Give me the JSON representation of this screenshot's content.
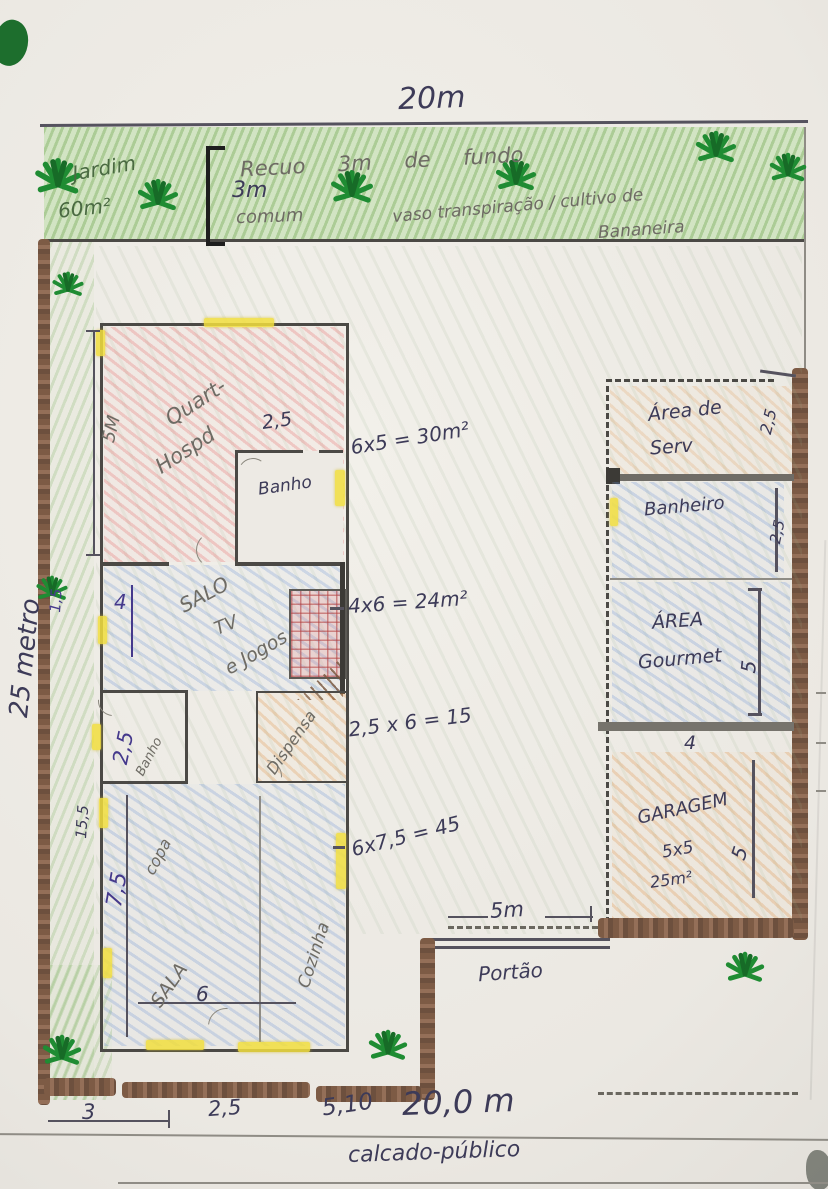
{
  "page": {
    "width_label": "20m",
    "depth_label": "25 metro"
  },
  "garden": {
    "name": "Jardim",
    "area": "60m²",
    "bracket": "3m",
    "recuo_line": "Recuo  3m  de  fundo",
    "comum": "comum",
    "note_main": "vaso transpiração / cultivo de",
    "note_tail": "Bananeira"
  },
  "rooms_left": {
    "quarto": {
      "l1": "Quart-",
      "l2": "Hospd",
      "dim": "5M"
    },
    "banho1": {
      "name": "Banho",
      "dim": "2,5"
    },
    "salao": {
      "l1": "SALO",
      "l2": "TV",
      "l3": "e Jogos"
    },
    "banho2": {
      "name": "Banho",
      "dim": "2,5"
    },
    "dispensa": {
      "name": "Dispensa"
    },
    "copa": {
      "name": "copa",
      "dim": "7,5"
    },
    "sala": {
      "name": "SALA",
      "dim": "6"
    },
    "cozinha": {
      "name": "Cozinha"
    },
    "side_dims": {
      "a": "1,5",
      "b": "4",
      "c": "15,5"
    }
  },
  "rooms_right": {
    "servico": {
      "l1": "Área de",
      "l2": "Serv",
      "dim": "2,5"
    },
    "banheiro": {
      "name": "Banheiro",
      "dim": "2,5"
    },
    "gourmet": {
      "l1": "ÁREA",
      "l2": "Gourmet",
      "dim_r": "5",
      "dim_b": "4"
    },
    "garagem": {
      "name": "GARAGEM",
      "size": "5x5",
      "area": "25m²",
      "dim_r": "5"
    }
  },
  "calc_notes": {
    "n1": "6x5 = 30m²",
    "n2": "4x6 = 24m²",
    "n3": "2,5 x 6 = 15",
    "n4": "6x7,5 = 45"
  },
  "street": {
    "gate_dim": "5m",
    "gate": "Portão",
    "d1": "3",
    "d2": "2,5",
    "d3": "5,10",
    "total": "20,0 m",
    "sidewalk": "calcado-público"
  }
}
